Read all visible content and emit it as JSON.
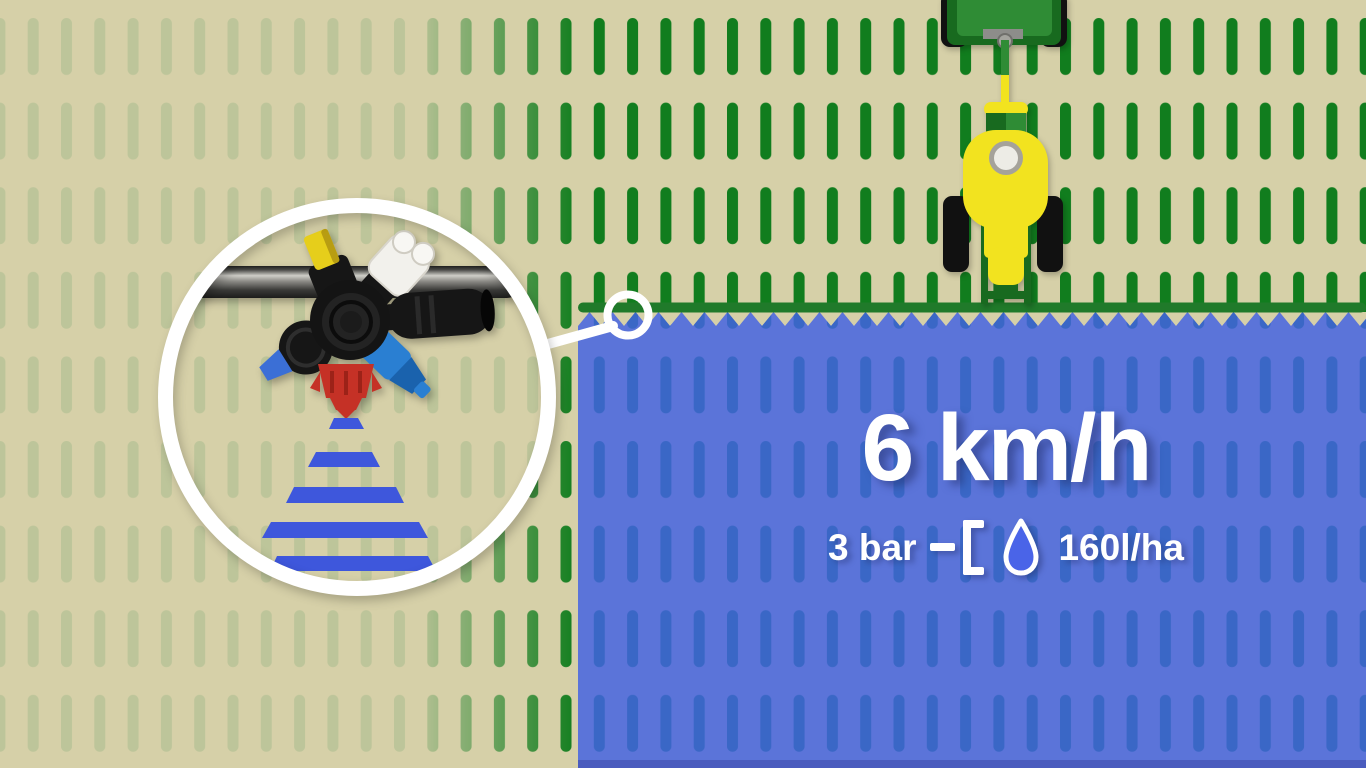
{
  "info_panel": {
    "speed": "6 km/h",
    "pressure": "3 bar",
    "rate": "160l/ha"
  },
  "icons": {
    "droplet": "water-droplet",
    "callout": "magnifier-circle"
  },
  "colors": {
    "field_beige": "#d6d0a8",
    "crop_pale": "#bdc59a",
    "crop_green": "#117d1e",
    "sprayed_blue": "#5b74d9",
    "sprayed_dash_blue": "#3a67c6",
    "sprayed_bottom_edge": "#4a5cbe",
    "boom_green": "#207a2a",
    "spray_fan_blue": "#3e57dc",
    "callout_white": "#ffffff",
    "tractor_green_dark": "#186a1f",
    "tractor_green_light": "#2f8c35",
    "tractor_yellow": "#f2e31f",
    "wheel_black": "#111111",
    "hitch_gray": "#8d8d8a",
    "turret_black": "#161616",
    "nozzle_yellow": "#e6ce1b",
    "nozzle_white": "#f2f1ec",
    "nozzle_blue": "#2a7fd2",
    "nozzle_blue_light": "#3b6fd6",
    "nozzle_red": "#c53126",
    "droplet_fill": "#4a64e8",
    "text_white": "#ffffff"
  }
}
